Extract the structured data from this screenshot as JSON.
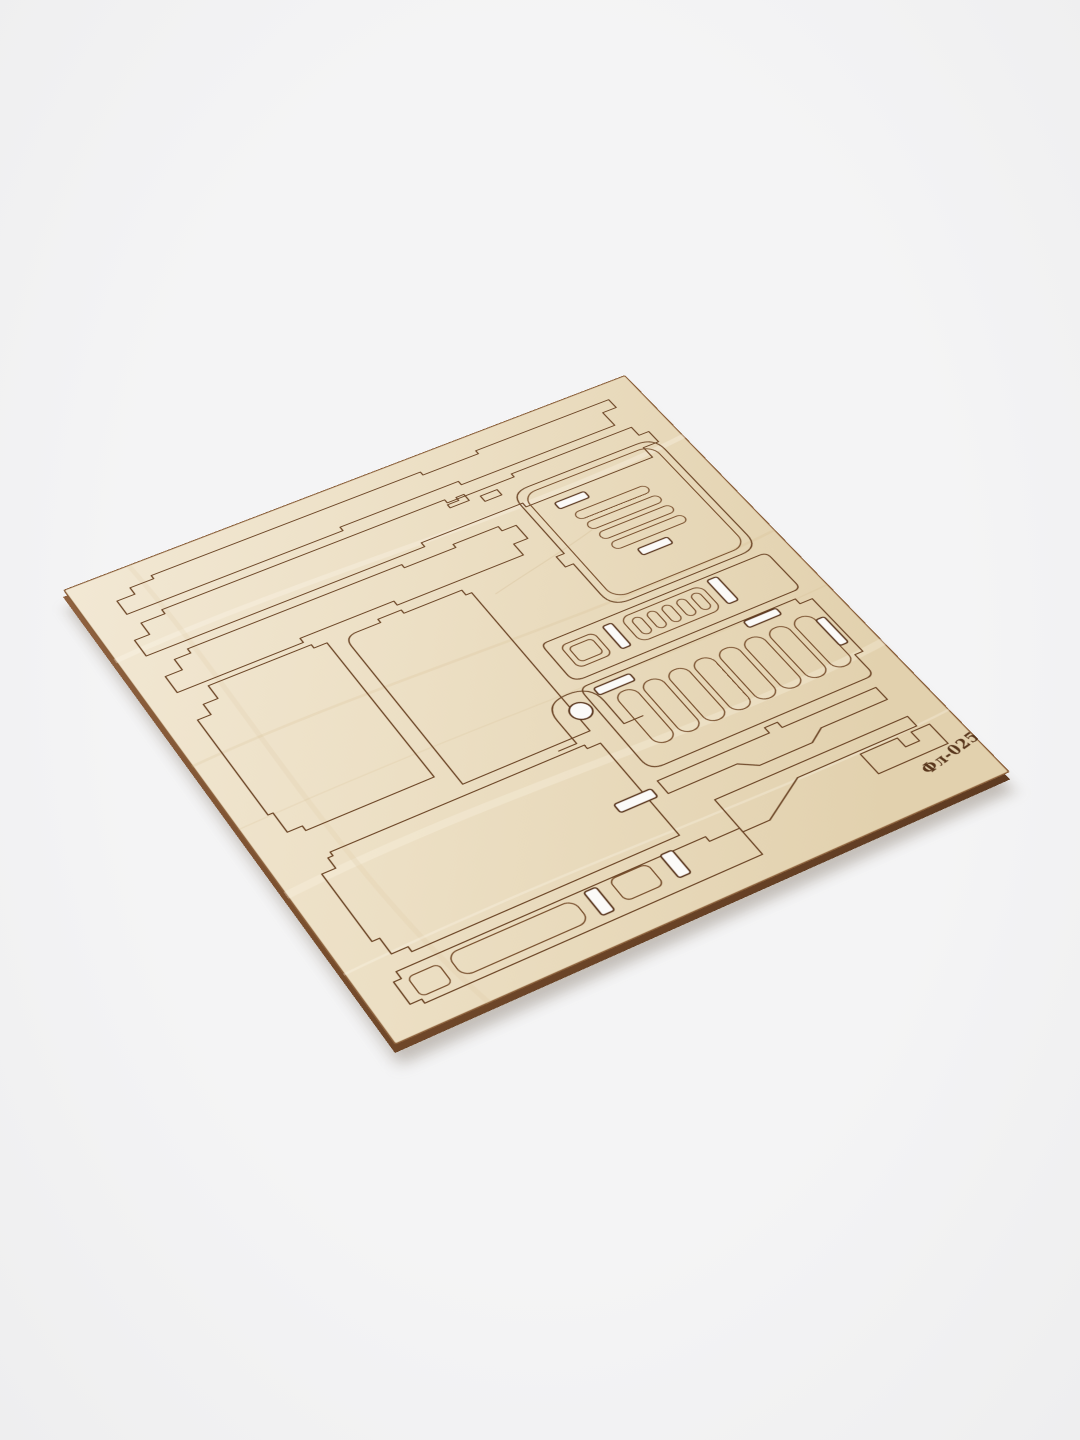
{
  "scene": {
    "type": "product-photo",
    "subject": "laser-cut plywood sheet with model kit parts, photographed at an angle on a plain background",
    "background_color": "#f2f2f3",
    "board": {
      "material": "plywood",
      "face_color": "#ecdfc4",
      "cut_line_color": "#6d4728",
      "engraving_color": "#58361c",
      "edge_color": "#7a4f2e",
      "through_slot_color": "#fbfaf8",
      "engraved_code": "Фл-025-2",
      "features": {
        "top_strips": 3,
        "large_panels": 3,
        "grille_panel_bars": 4,
        "small_oval_slots": 5,
        "ladder_panel_slots": 8,
        "keyhole_circle": 1,
        "through_slots": 10
      }
    }
  }
}
